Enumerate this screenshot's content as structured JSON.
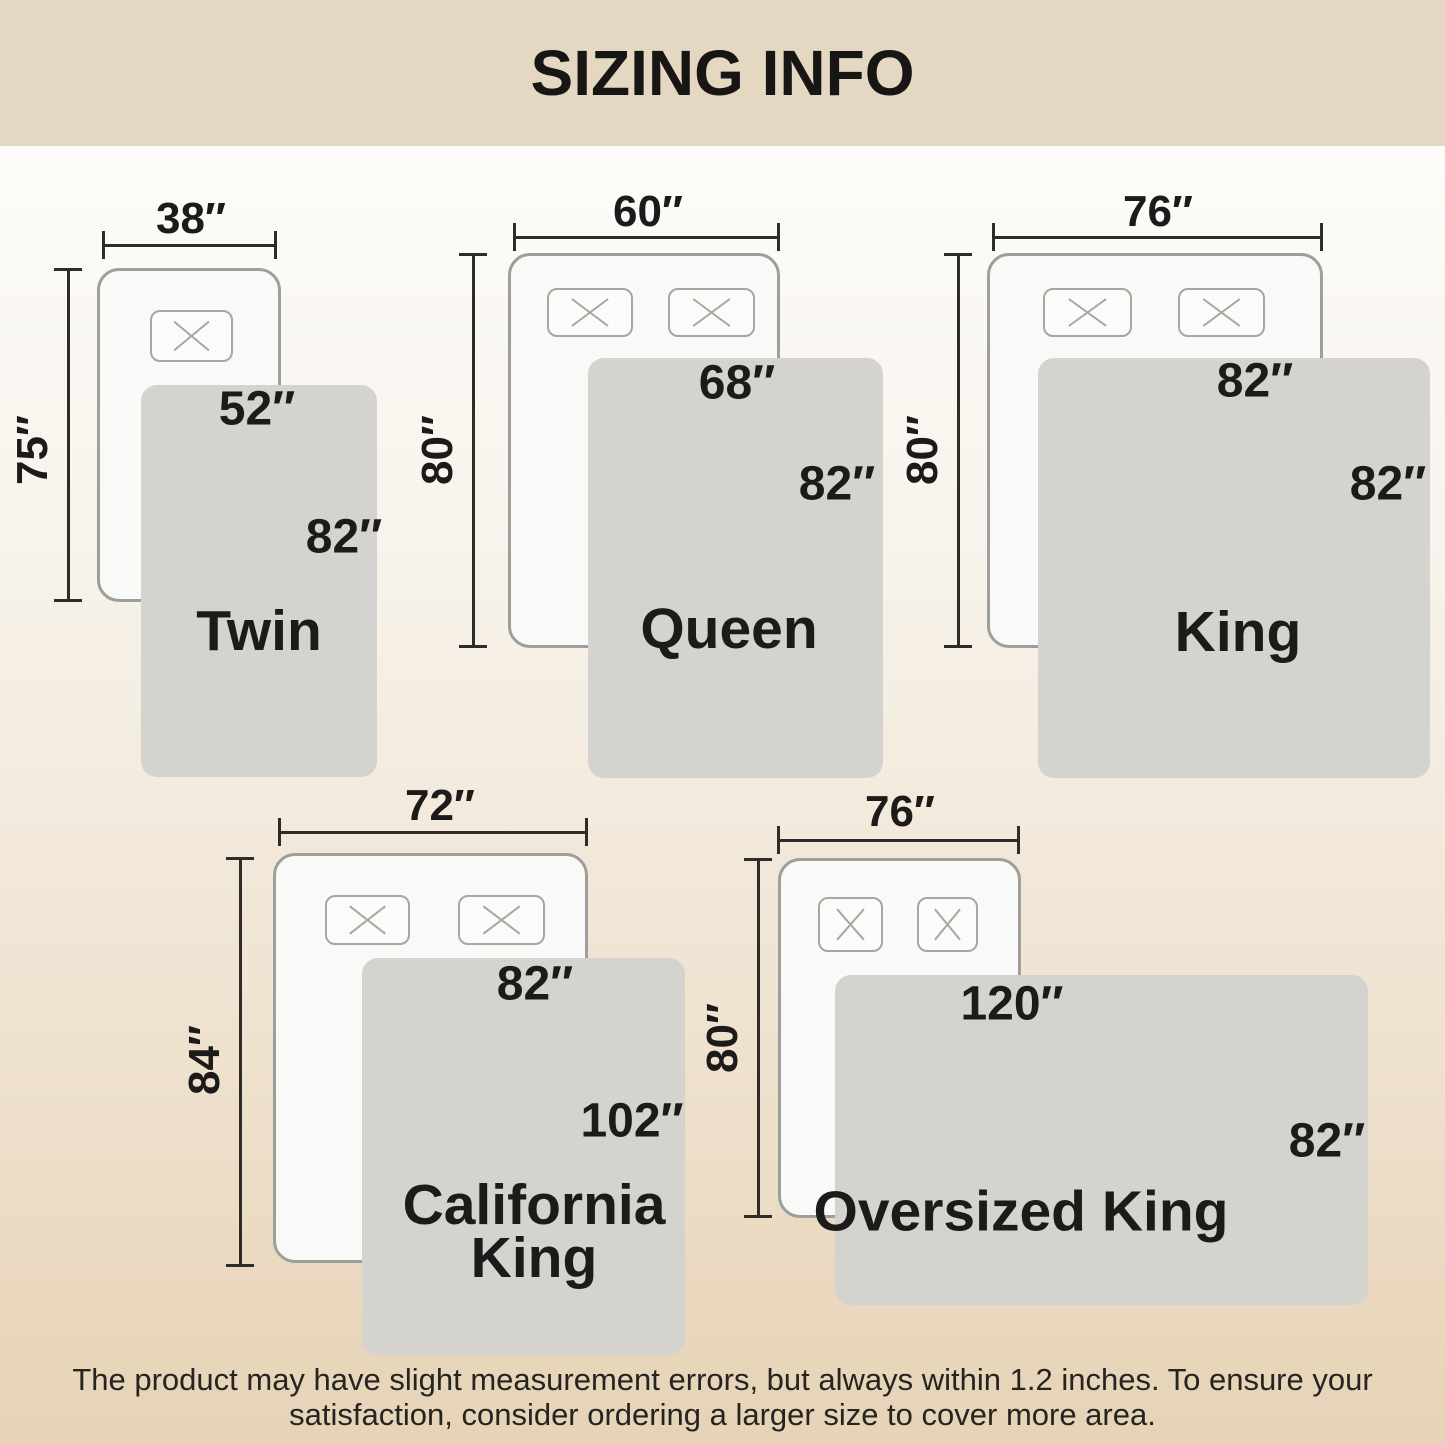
{
  "title": "SIZING INFO",
  "sizes": [
    {
      "name": "Twin",
      "mattress_width": "38″",
      "mattress_length": "75″",
      "blanket_width": "52″",
      "blanket_length": "82″"
    },
    {
      "name": "Queen",
      "mattress_width": "60″",
      "mattress_length": "80″",
      "blanket_width": "68″",
      "blanket_length": "82″"
    },
    {
      "name": "King",
      "mattress_width": "76″",
      "mattress_length": "80″",
      "blanket_width": "82″",
      "blanket_length": "82″"
    },
    {
      "name": "California King",
      "mattress_width": "72″",
      "mattress_length": "84″",
      "blanket_width": "82″",
      "blanket_length": "102″"
    },
    {
      "name": "Oversized King",
      "mattress_width": "76″",
      "mattress_length": "80″",
      "blanket_width": "120″",
      "blanket_length": "82″"
    }
  ],
  "footer": {
    "line1": "The product may have slight measurement errors, but always within 1.2 inches. To ensure your",
    "line2": "satisfaction, consider ordering a larger size to cover more area."
  },
  "colors": {
    "banner_background": "#e4d8c3",
    "page_background_top": "#fdfcfa",
    "page_background_bottom": "#e6d3b8",
    "blanket_fill": "#d4d3d0",
    "mattress_fill": "#f9f9f7",
    "outline_gray": "#9e9e9a",
    "dimension_line": "#2e2c28",
    "text": "#1c1b19"
  }
}
